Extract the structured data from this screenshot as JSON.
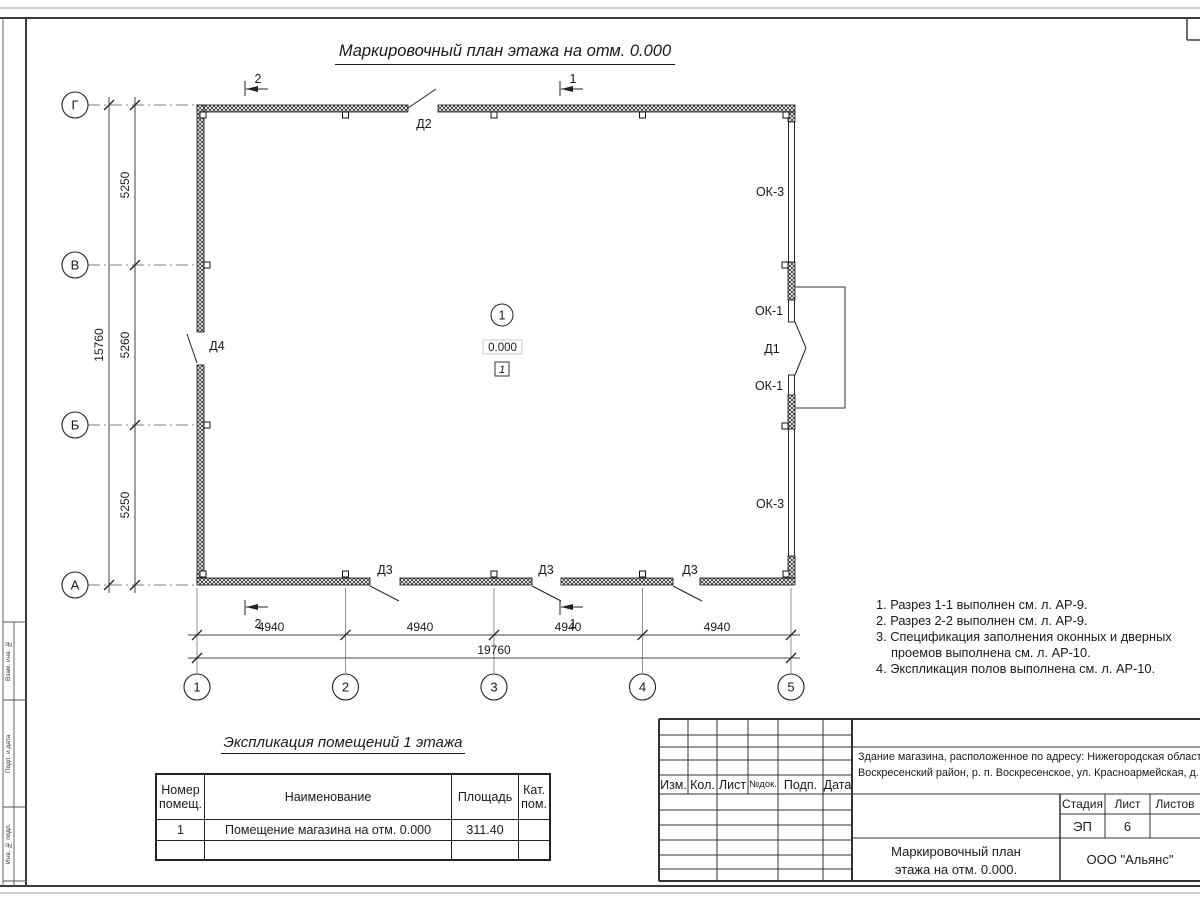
{
  "sheet": {
    "title": "Маркировочный план этажа на отм. 0.000",
    "strip_labels": [
      "Взам. инв. №",
      "Подп. и дата",
      "Инв. № подл."
    ]
  },
  "plan": {
    "axis_rows": [
      "Г",
      "В",
      "Б",
      "А"
    ],
    "axis_cols": [
      "1",
      "2",
      "3",
      "4",
      "5"
    ],
    "dim_left_segments": [
      "5250",
      "5260",
      "5250"
    ],
    "dim_left_total": "15760",
    "dim_bottom_segments": [
      "4940",
      "4940",
      "4940",
      "4940"
    ],
    "dim_bottom_total": "19760",
    "section_mark_1": "1",
    "section_mark_2": "2",
    "door_d1": "Д1",
    "door_d2": "Д2",
    "door_d3": "Д3",
    "door_d4": "Д4",
    "window_ok1": "ОК-1",
    "window_ok3": "ОК-3",
    "room_number": "1",
    "room_elevation": "0.000",
    "floor_type_tag": "1"
  },
  "notes": {
    "line1": "1. Разрез 1-1 выполнен см. л. АР-9.",
    "line2": "2. Разрез 2-2 выполнен см. л. АР-9.",
    "line3": "3. Спецификация заполнения оконных и дверных",
    "line4": "проемов выполнена см. л. АР-10.",
    "line5": "4. Экспликация полов выполнена см. л. АР-10."
  },
  "room_table": {
    "title": "Экспликация помещений 1 этажа",
    "col_number": "Номер помещ.",
    "col_name": "Наименование",
    "col_area": "Площадь",
    "col_cat": "Кат. пом.",
    "row1_number": "1",
    "row1_name": "Помещение магазина на отм. 0.000",
    "row1_area": "311.40",
    "row1_cat": ""
  },
  "title_block": {
    "rev_headers": [
      "Изм.",
      "Кол.",
      "Лист",
      "№док.",
      "Подп.",
      "Дата"
    ],
    "project_line1": "Здание магазина, расположенное по адресу: Нижегородская область,",
    "project_line2": "Воскресенский район, р. п. Воскресенское, ул. Красноармейская, д. 1",
    "stage_label": "Стадия",
    "sheet_label": "Лист",
    "sheets_label": "Листов",
    "stage_value": "ЭП",
    "sheet_value": "6",
    "drawing_name_line1": "Маркировочный план",
    "drawing_name_line2": "этажа на отм. 0.000.",
    "company": "ООО \"Альянс\""
  }
}
